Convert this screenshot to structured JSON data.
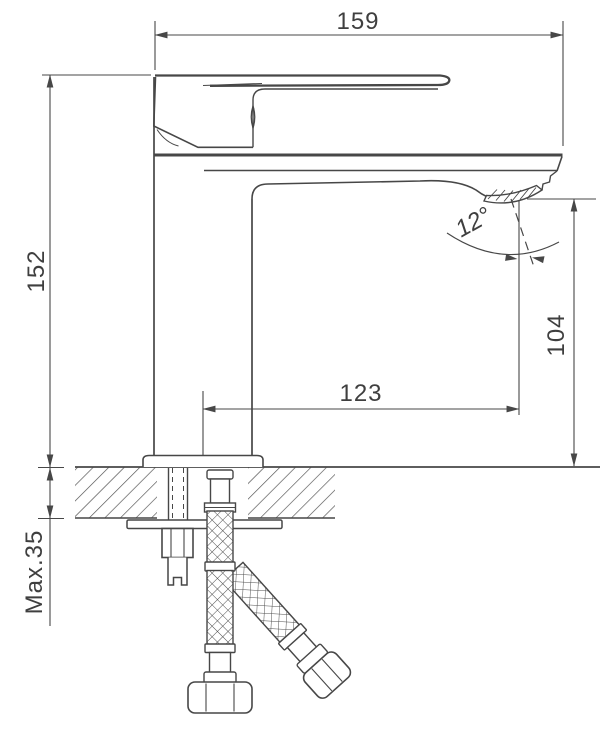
{
  "drawing": {
    "type": "technical-dimension-drawing",
    "subject": "single-lever basin mixer faucet, side elevation with deck mounting cross-section and flexible supply hoses",
    "background_color": "#ffffff",
    "line_color": "#474747",
    "text_color": "#3f3f3f",
    "labels": {
      "total_length_mm": "159",
      "body_height_mm": "152",
      "spout_reach_mm": "123",
      "spout_outlet_height_mm": "104",
      "spout_angle_deg": "12°",
      "max_mounting_thickness_mm": "Max.35"
    }
  }
}
